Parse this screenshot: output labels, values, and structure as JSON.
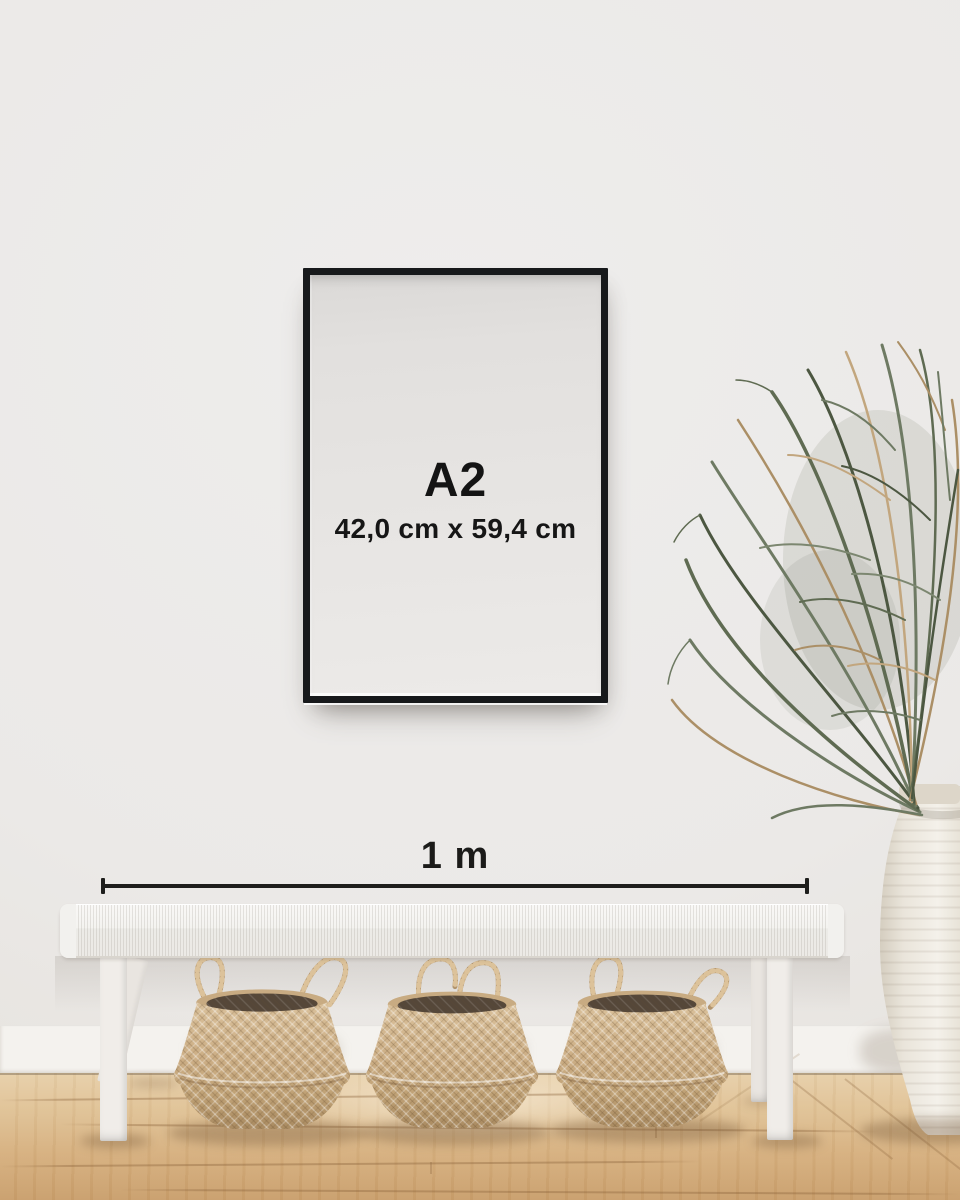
{
  "image": {
    "kind": "poster-size-guide-photo",
    "frame_label": {
      "size": "A2",
      "dimensions": "42,0 cm x 59,4 cm"
    },
    "scale_bar": {
      "label": "1 m"
    },
    "colors": {
      "wall": "#ebe9e7",
      "baseboard": "#f4f2ee",
      "floor_wood": "#d9b584",
      "frame_border": "#17191b",
      "poster_paper": "#e6e4e2",
      "label_text": "#141414",
      "measure_line": "#1e1e1c",
      "bench_white": "#f3f1ed",
      "basket_seagrass": "#c9ac83",
      "basket_interior": "#524536",
      "plant_green": "#65715a",
      "plant_dried": "#ad9168",
      "vase_ceramic": "#efece6"
    },
    "objects": [
      "poster-frame",
      "scale-bar",
      "woven-bench",
      "seagrass-basket",
      "seagrass-basket",
      "seagrass-basket",
      "palm-plant",
      "ceramic-vase",
      "wood-floor"
    ]
  }
}
